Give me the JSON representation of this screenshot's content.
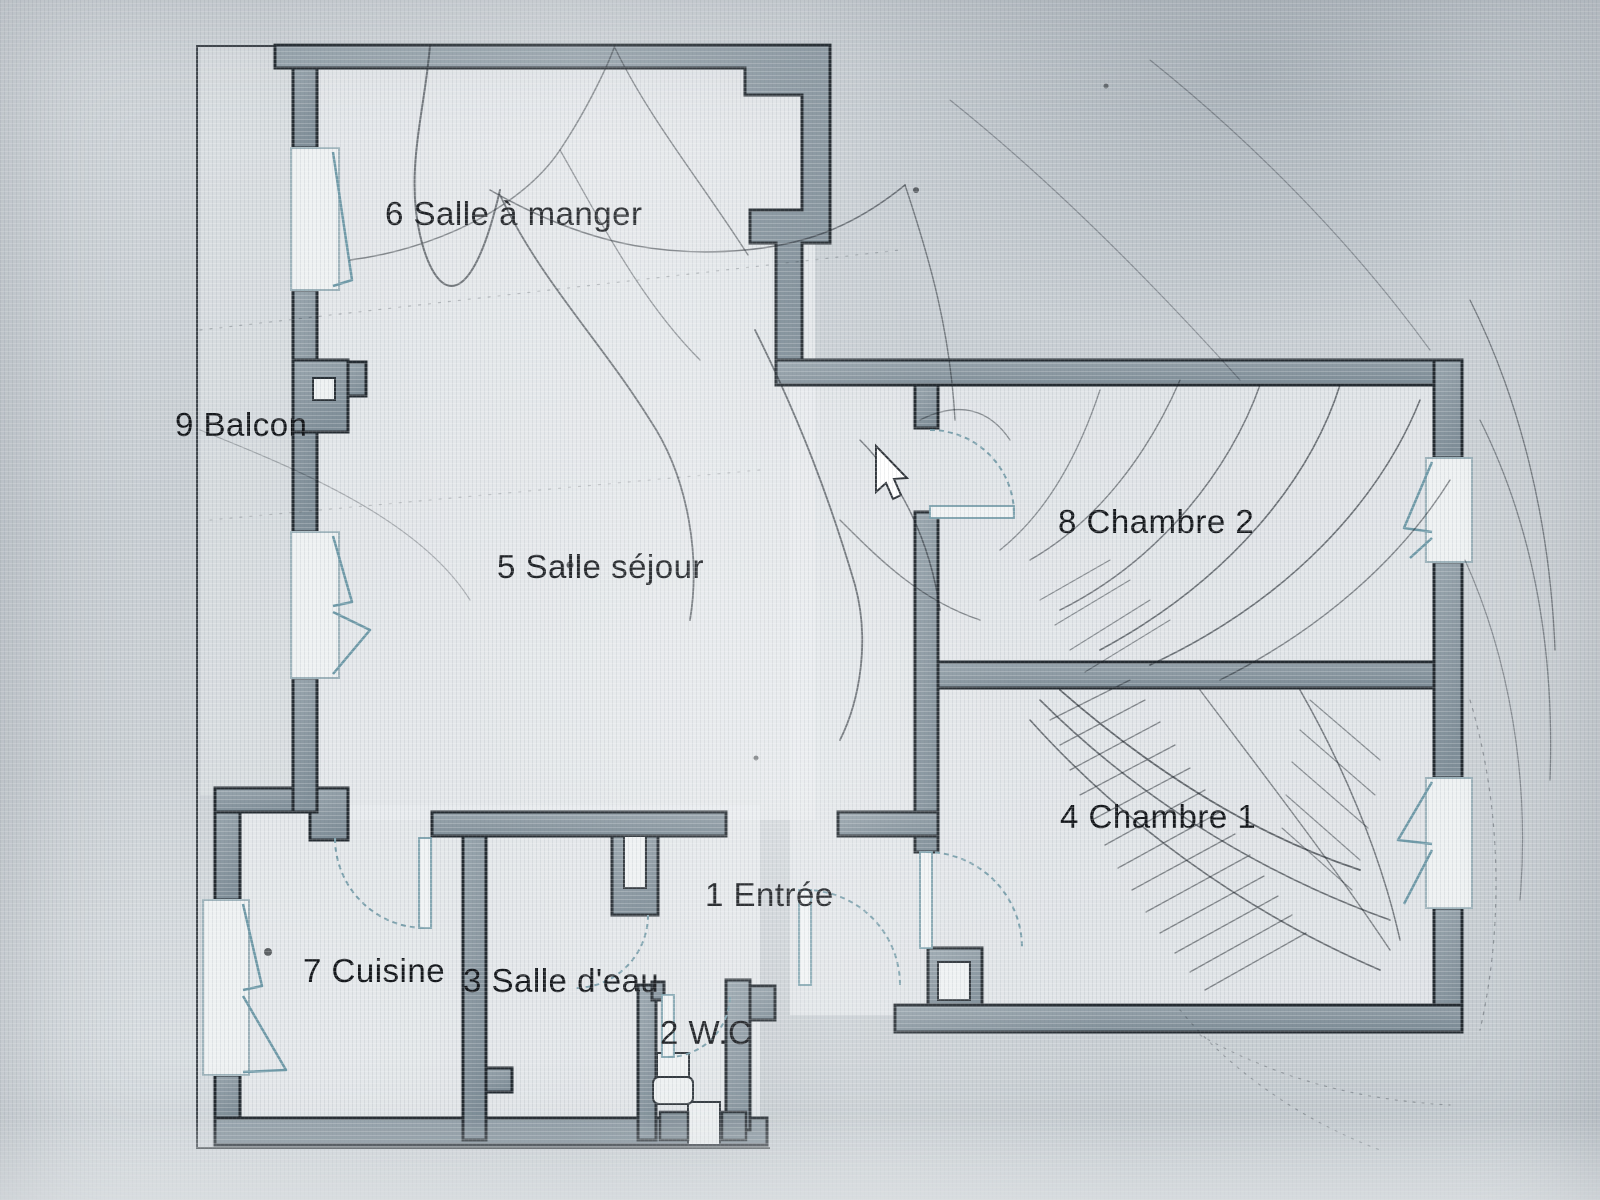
{
  "plan": {
    "kind": "apartment-floor-plan",
    "language": "fr",
    "photo_condition": "photographed screen with cracked glass"
  },
  "rooms": [
    {
      "number": "1",
      "name": "Entrée",
      "label": "1 Entrée"
    },
    {
      "number": "2",
      "name": "W.C",
      "label": "2 W.C"
    },
    {
      "number": "3",
      "name": "Salle d'eau",
      "label": "3 Salle d'eau"
    },
    {
      "number": "4",
      "name": "Chambre 1",
      "label": "4 Chambre 1"
    },
    {
      "number": "5",
      "name": "Salle séjour",
      "label": "5 Salle séjour"
    },
    {
      "number": "6",
      "name": "Salle à manger",
      "label": "6 Salle à manger"
    },
    {
      "number": "7",
      "name": "Cuisine",
      "label": "7 Cuisine"
    },
    {
      "number": "8",
      "name": "Chambre 2",
      "label": "8 Chambre 2"
    },
    {
      "number": "9",
      "name": "Balcon",
      "label": "9 Balcon"
    }
  ],
  "cursor": {
    "visible": true,
    "shape": "arrow-pointer",
    "x": 876,
    "y": 447
  },
  "colors": {
    "background": "#cbd1d5",
    "plan_interior": "#e9ecee",
    "wall_fill": "#8d9aa3",
    "wall_outline": "#242b31",
    "window_accent": "#6f9aa8",
    "ink": "#15181c"
  }
}
